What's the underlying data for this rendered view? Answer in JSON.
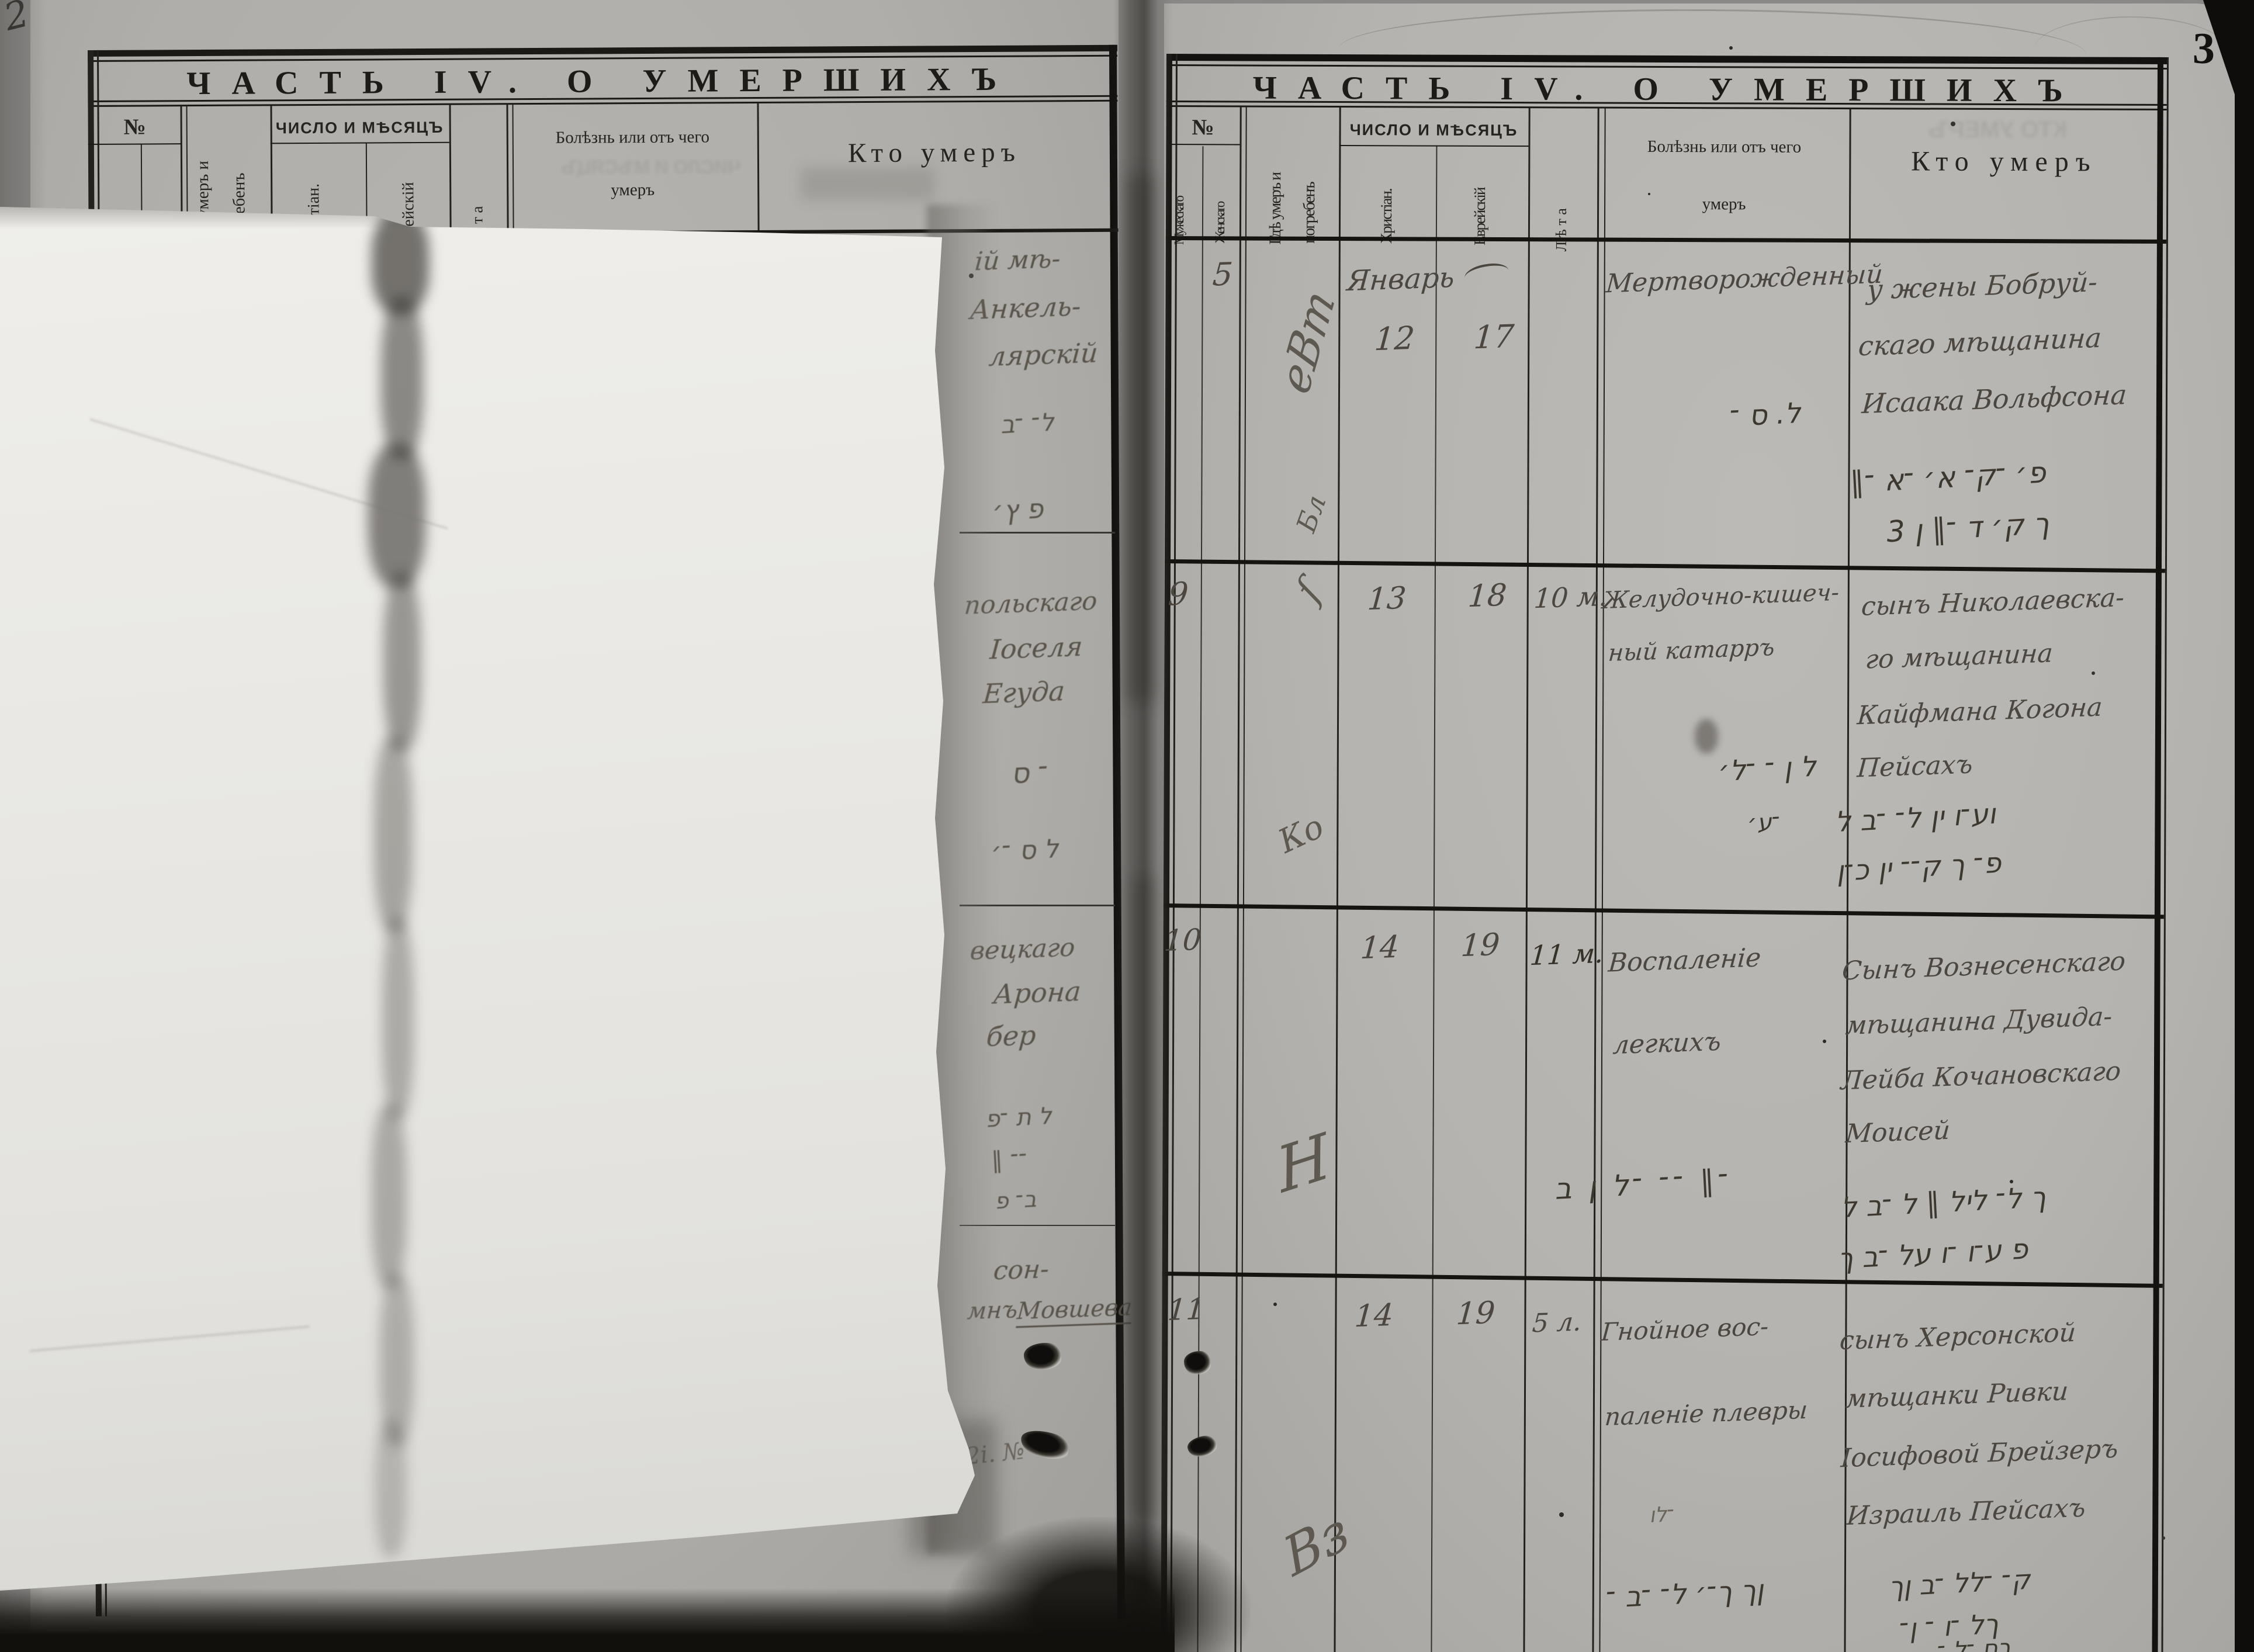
{
  "scan": {
    "page_number": "3",
    "prev_page_corner_mark": "2",
    "palette": {
      "paper": "#b5b3af",
      "overlay_sheet": "#eae9e5",
      "table_ink": "#1b1916",
      "handwriting_ink": "#4b463f",
      "background": "#8a8886"
    }
  },
  "left_page": {
    "title": "ЧАСТЬ IV. О УМЕРШИХЪ",
    "header": {
      "no": "№",
      "male": "Мужескаго",
      "female": "Женскаго",
      "where_line1": "Гдѣ умеръ и",
      "where_line2": "погребенъ",
      "date_group": "ЧИСЛО И МѢСЯЦЪ",
      "date_christian": "Христіан.",
      "date_jewish": "Еврейскій",
      "age": "Л ѣ т а",
      "illness_line1": "Болѣзнь или отъ чего",
      "illness_line2": "умеръ",
      "who": "Кто умеръ"
    },
    "fragments": [
      {
        "lines": [
          "ій мѣ-",
          "Анкель-",
          "лярскій"
        ],
        "script": [
          "ל־ ־ב",
          "פ ץ׳"
        ]
      },
      {
        "lines": [
          "польскаго",
          "Іоселя",
          "Егуда"
        ],
        "script": [
          "־ ס",
          "ל ס ־׳"
        ]
      },
      {
        "lines": [
          "вецкаго",
          "Арона",
          "бер"
        ],
        "script": [
          "ל ת ־פ",
          "־־ ∥",
          "ב־ פ"
        ]
      },
      {
        "lines": [
          "сон-",
          "мнъ",
          "Мовшева"
        ],
        "script": [
          "2і. №"
        ]
      }
    ]
  },
  "right_page": {
    "title": "ЧАСТЬ IV. О УМЕРШИХЪ",
    "header": {
      "no": "№",
      "male": "Мужескаго",
      "female": "Женскаго",
      "where_line1": "Гдѣ умеръ и",
      "where_line2": "погребенъ",
      "date_group": "ЧИСЛО И МѢСЯЦЪ",
      "date_christian": "Христіан.",
      "date_jewish": "Еврейскій",
      "age": "Л ѣ т а",
      "illness_line1": "Болѣзнь или отъ чего",
      "illness_line2": "умеръ",
      "who": "Кто умеръ"
    },
    "entries": [
      {
        "no_female": "5",
        "where_script": "еВт",
        "where_script2": "Бл",
        "date_christian_month": "Январь",
        "date_christian_day": "12",
        "date_jewish_day": "17",
        "cause_lines": [
          "Мертворожденный"
        ],
        "cause_script": [
          "ל. ס ־"
        ],
        "who_lines": [
          "у жены Бобруй-",
          "скаго мѣщанина",
          "Исаака Вольфсона"
        ],
        "who_script": [
          "פ׳ ־ק־ א׳ ־א ־∥",
          "ך ק׳ ד ־∥ ן 3"
        ]
      },
      {
        "no_male": "9",
        "where_script": "ſ",
        "where_script2": "Ко",
        "date_christian_day": "13",
        "date_jewish_day": "18",
        "age": "10 м.",
        "cause_lines": [
          "Желудочно-кишеч-",
          "ный катарръ"
        ],
        "cause_script": [
          "ל ן ־ ־ל׳",
          "־ע׳"
        ],
        "who_lines": [
          "сынъ Николаевска-",
          "го мѣщанина",
          "Кайфмана Когона",
          "Пейсахъ"
        ],
        "who_script": [
          "וע־ו ין ל־ ־ב ל",
          "פ־ ך ק־־ ין כ־ן"
        ]
      },
      {
        "no_male": "10",
        "where_script": "Н",
        "date_christian_day": "14",
        "date_jewish_day": "19",
        "age": "11 м.",
        "cause_lines": [
          "Воспаленіе",
          "легкихъ"
        ],
        "cause_script": [
          "־∥ ־־ ־ל ן ב"
        ],
        "who_lines": [
          "Сынъ Вознесенскаго",
          "мѣщанина Дувида-",
          "Лейба Кочановскаго",
          "Моисей"
        ],
        "who_script": [
          "ך ל־ ליל ∥ ל ־ב ל",
          "פ ע־ו ־ו על ־ב ך"
        ]
      },
      {
        "no_male": "11",
        "where_script": "Вз",
        "date_christian_day": "14",
        "date_jewish_day": "19",
        "age": "5 л.",
        "cause_lines": [
          "Гнойное вос-",
          "паленіе плевры"
        ],
        "cause_mark": "־לו",
        "cause_script": [
          "ןך ך־׳ ל־ ־ב ־"
        ],
        "who_lines": [
          "сынъ Херсонской",
          "мѣщанки Ривки",
          "Іосифовой Брейзеръ",
          "Израиль Пейсахъ"
        ],
        "who_script": [
          "ק־ ־לל ־ב ןך",
          "ךל ־ו ־ ן־",
          "ךם ־ל ־"
        ]
      }
    ]
  },
  "ghosts": {
    "left_header_bleed": "ЧИСЛО И МѢСЯЦЪ",
    "right_header_bleed": "КТО УМЕРЪ"
  }
}
